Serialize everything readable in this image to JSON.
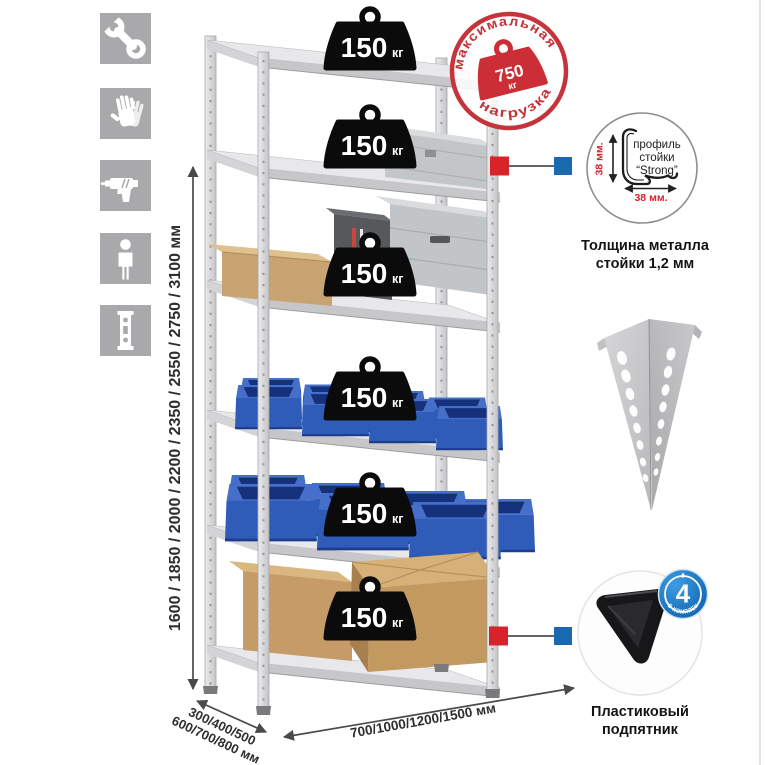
{
  "colors": {
    "accent_red": "#d8232a",
    "accent_blue": "#1a6ab1",
    "stamp_red": "#c5343a",
    "bin_blue": "#2e5cb8",
    "metal_gray": "#d9d9db",
    "icon_bg": "#a9a9ab"
  },
  "sidebar_icons": {
    "items": [
      "wrench-icon",
      "gloves-icon",
      "drill-icon",
      "person-icon",
      "post-profile-icon"
    ]
  },
  "height_dimension": {
    "label": "1600 / 1850 / 2000 / 2200 / 2350 / 2550 / 2750 / 3100 мм"
  },
  "rack": {
    "shelf_count": 6,
    "badge": {
      "value": "150",
      "unit": "кг"
    }
  },
  "max_load_stamp": {
    "arc_top": "максимальная",
    "arc_bottom": "нагрузка",
    "value": "750",
    "unit": "кг"
  },
  "profile_detail": {
    "label_line1": "профиль",
    "label_line2": "стойки",
    "label_line3": "“Strong”",
    "vertical_dim": "38 мм.",
    "horizontal_dim": "38 мм.",
    "caption_line1": "Толщина металла",
    "caption_line2": "стойки 1,2 мм"
  },
  "foot_detail": {
    "badge_value": "4",
    "badge_arc_text": "в комплекте",
    "caption_line1": "Пластиковый",
    "caption_line2": "подпятник"
  },
  "depth_dimension": {
    "line1": "300/400/500",
    "line2": "600/700/800 мм"
  },
  "width_dimension": {
    "label": "700/1000/1200/1500 мм"
  }
}
